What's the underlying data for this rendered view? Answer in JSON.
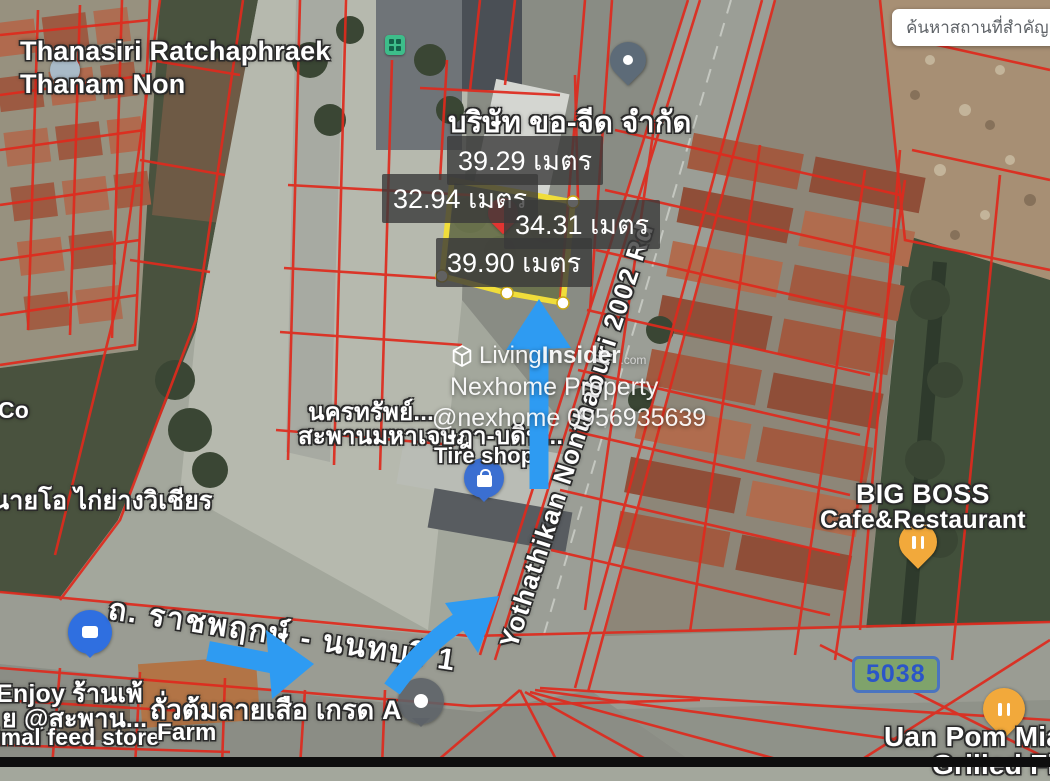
{
  "search": {
    "placeholder_text": "ค้นหาสถานที่สำคัญ"
  },
  "plot": {
    "top_length": "39.29 เมตร",
    "left_length": "32.94 เมตร",
    "middle_length": "34.31 เมตร",
    "bottom_length": "39.90 เมตร"
  },
  "labels": {
    "estate_line1": "Thanasiri Ratchaphraek",
    "estate_line2": "Thanam Non",
    "company": "บริษัท ขอ-จีด จำกัด",
    "nakhonsap_line1": "นครทรัพย์...",
    "nakhonsap_line2": "สะพานมหาเจษฎา-บดิน...",
    "tire_shop": "Tire shop",
    "grilled_chicken": "นายโอ ไก่ย่างวิเชียร",
    "co_partial": "Co",
    "enjoy_line1": "Enjoy ร้านเพ้",
    "enjoy_line2": "ย @สะพาน...",
    "enjoy_line3": "imal feed store",
    "peanut_shop": "ถั่วต้มลายเสือ เกรด A",
    "farm": "Farm",
    "bigboss_line1": "BIG BOSS",
    "bigboss_line2": "Cafe&Restaurant",
    "uanpom_line1": "Uan Pom Mian",
    "uanpom_line2": "Grilled Fish"
  },
  "roads": {
    "ratchaphruek": "ถ. ราชพฤกษ์ - นนทบุรี 1",
    "yothathikan": "Yothathikan Nonthaburi 2002 Rd",
    "route_number": "5038"
  },
  "watermark": {
    "brand_living": "Living",
    "brand_insider": "Insider",
    "brand_tld": ".com",
    "agency": "Nexhome Property",
    "contact": "@nexhome 0956935639"
  },
  "icons": {
    "estate_pin": "map-pin",
    "company_pin": "map-pin",
    "plot_pin": "red-map-pin",
    "factory_marker": "green-building-marker",
    "tire_pin": "shopping-bag-pin",
    "cafe_pin": "cafe-place-pin",
    "farm_pin": "gray-place-pin",
    "bigboss_pin": "restaurant-pin",
    "uanpom_pin": "restaurant-pin",
    "watermark_logo": "cube-logo"
  },
  "colors": {
    "arrow_blue": "#2e9bf2",
    "plot_yellow": "#f0dd3a",
    "parcel_red": "#df2a1d",
    "badge_green": "#7fa36b",
    "badge_border_blue": "#4a74c0",
    "badge_text_blue": "#2b55c8",
    "label_box_bg": "#3a3a3a"
  }
}
